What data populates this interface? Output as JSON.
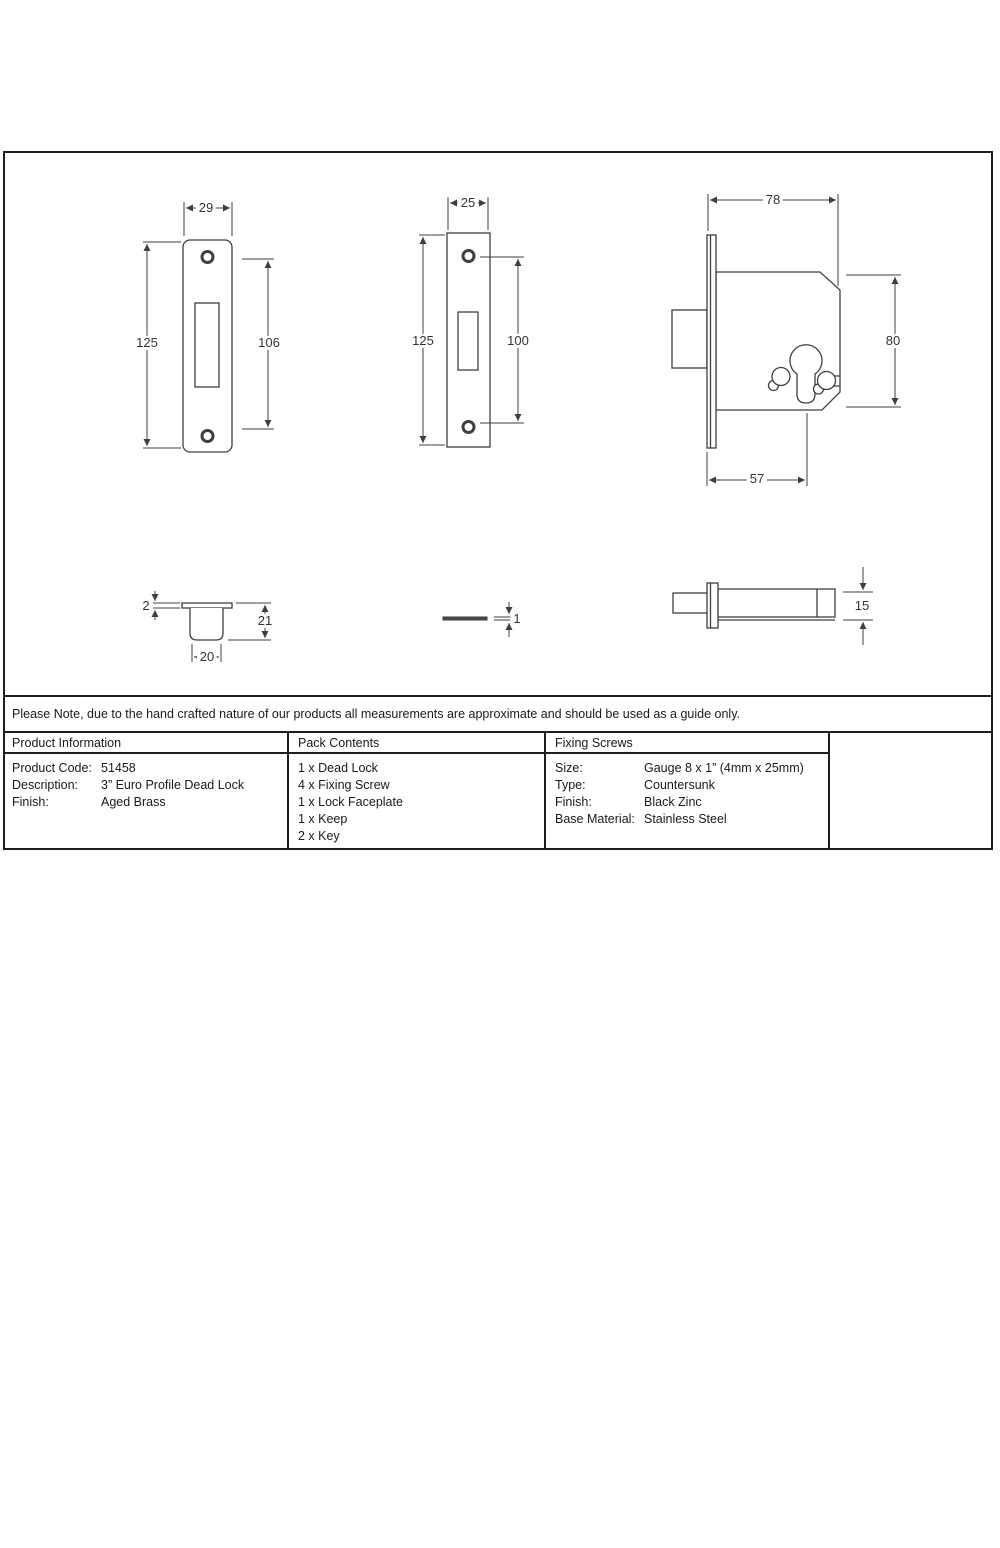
{
  "colors": {
    "line": "#3f3f3f",
    "text": "#1a1a1a",
    "background": "#ffffff"
  },
  "note_row": {
    "text": "Please Note, due to the hand crafted nature of our products all measurements are approximate and should be used as a guide only."
  },
  "product_information": {
    "header": "Product Information",
    "rows": [
      {
        "label": "Product Code:",
        "value": "51458"
      },
      {
        "label": "Description:",
        "value": "3” Euro Profile Dead Lock"
      },
      {
        "label": "Finish:",
        "value": "Aged Brass"
      }
    ]
  },
  "pack_contents": {
    "header": "Pack Contents",
    "items": [
      "1 x Dead Lock",
      "4 x Fixing Screw",
      "1 x Lock Faceplate",
      "1 x Keep",
      "2 x Key"
    ]
  },
  "fixing_screws": {
    "header": "Fixing Screws",
    "rows": [
      {
        "label": "Size:",
        "value": "Gauge 8 x 1” (4mm x 25mm)"
      },
      {
        "label": "Type:",
        "value": "Countersunk"
      },
      {
        "label": "Finish:",
        "value": "Black Zinc"
      },
      {
        "label": "Base Material:",
        "value": "Stainless Steel"
      }
    ]
  },
  "logo": {
    "tagline": "From the",
    "brand_rest": "nvil",
    "registered_mark": "®",
    "diamond": "♦"
  },
  "drawings": {
    "faceplate_front": {
      "width": "29",
      "height": "125",
      "screw_span": "106"
    },
    "keep_plate_front": {
      "width": "25",
      "height": "125",
      "screw_span": "100"
    },
    "lock_case_front": {
      "width": "78",
      "height": "80",
      "backset": "57"
    },
    "keep_cup_side": {
      "flange_thickness": "2",
      "depth": "21",
      "width": "20"
    },
    "faceplate_side": {
      "thickness": "1"
    },
    "lock_case_side": {
      "thickness": "15"
    }
  }
}
